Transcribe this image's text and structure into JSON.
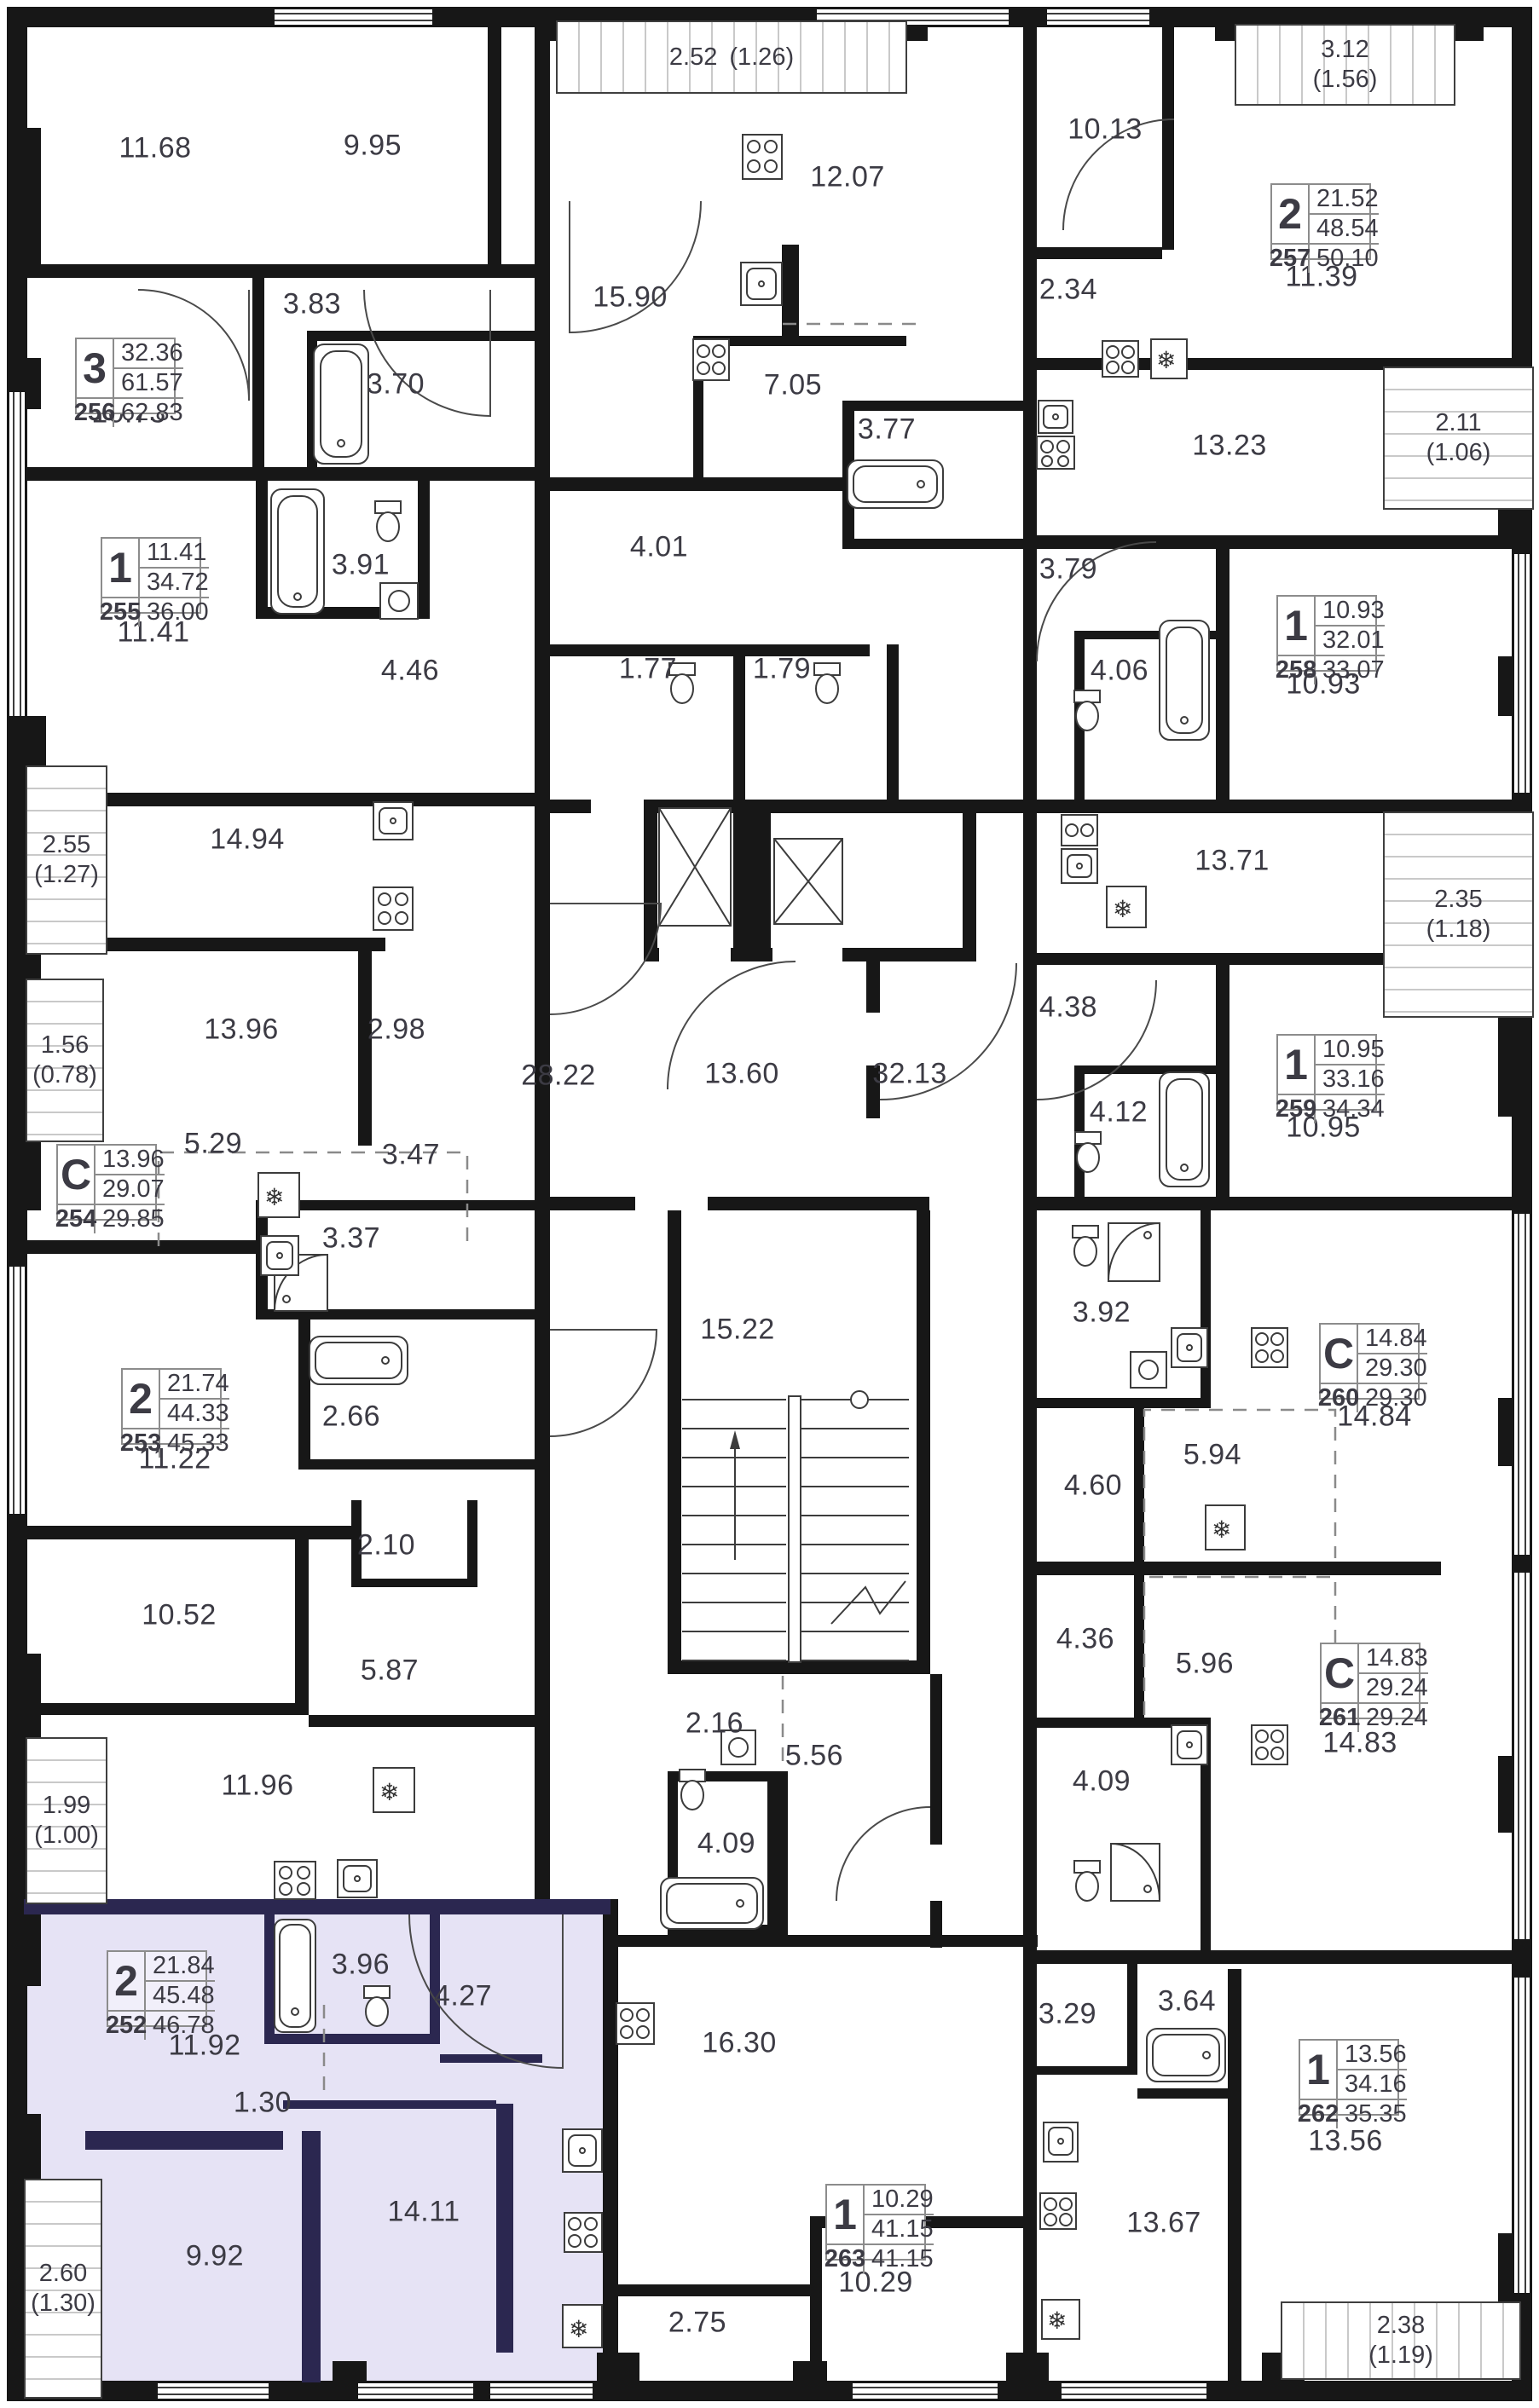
{
  "plan": {
    "highlight_color": "#e6e3f5",
    "wall_color": "#171717",
    "highlight_wall_color": "#2b2750",
    "apartments": [
      {
        "number": "256",
        "type": "3",
        "living": "32.36",
        "area": "61.57",
        "total": "62.83",
        "highlighted": false
      },
      {
        "number": "255",
        "type": "1",
        "living": "11.41",
        "area": "34.72",
        "total": "36.00",
        "highlighted": false
      },
      {
        "number": "254",
        "type": "С",
        "living": "13.96",
        "area": "29.07",
        "total": "29.85",
        "highlighted": false
      },
      {
        "number": "253",
        "type": "2",
        "living": "21.74",
        "area": "44.33",
        "total": "45.33",
        "highlighted": false
      },
      {
        "number": "252",
        "type": "2",
        "living": "21.84",
        "area": "45.48",
        "total": "46.78",
        "highlighted": true
      },
      {
        "number": "257",
        "type": "2",
        "living": "21.52",
        "area": "48.54",
        "total": "50.10",
        "highlighted": false
      },
      {
        "number": "258",
        "type": "1",
        "living": "10.93",
        "area": "32.01",
        "total": "33.07",
        "highlighted": false
      },
      {
        "number": "259",
        "type": "1",
        "living": "10.95",
        "area": "33.16",
        "total": "34.34",
        "highlighted": false
      },
      {
        "number": "260",
        "type": "С",
        "living": "14.84",
        "area": "29.30",
        "total": "29.30",
        "highlighted": false
      },
      {
        "number": "261",
        "type": "С",
        "living": "14.83",
        "area": "29.24",
        "total": "29.24",
        "highlighted": false
      },
      {
        "number": "262",
        "type": "1",
        "living": "13.56",
        "area": "34.16",
        "total": "35.35",
        "highlighted": false
      },
      {
        "number": "263",
        "type": "1",
        "living": "10.29",
        "area": "41.15",
        "total": "41.15",
        "highlighted": false
      }
    ],
    "balconies": [
      {
        "area": "2.52",
        "reduced": "(1.26)"
      },
      {
        "area": "3.12",
        "reduced": "(1.56)"
      },
      {
        "area": "2.11",
        "reduced": "(1.06)"
      },
      {
        "area": "2.35",
        "reduced": "(1.18)"
      },
      {
        "area": "2.55",
        "reduced": "(1.27)"
      },
      {
        "area": "1.56",
        "reduced": "(0.78)"
      },
      {
        "area": "1.99",
        "reduced": "(1.00)"
      },
      {
        "area": "2.60",
        "reduced": "(1.30)"
      },
      {
        "area": "2.38",
        "reduced": "(1.19)"
      }
    ],
    "rooms": [
      "11.68",
      "9.95",
      "3.83",
      "3.70",
      "10.73",
      "15.90",
      "12.07",
      "7.05",
      "10.13",
      "2.34",
      "11.39",
      "3.77",
      "4.01",
      "1.77",
      "1.79",
      "3.91",
      "11.41",
      "4.46",
      "13.23",
      "3.79",
      "4.06",
      "10.93",
      "14.94",
      "13.96",
      "2.98",
      "28.22",
      "13.60",
      "32.13",
      "4.38",
      "13.71",
      "10.95",
      "4.12",
      "5.29",
      "3.47",
      "3.37",
      "15.22",
      "3.92",
      "11.22",
      "2.66",
      "2.10",
      "14.84",
      "5.94",
      "4.60",
      "10.52",
      "5.87",
      "4.36",
      "5.96",
      "14.83",
      "11.96",
      "2.16",
      "5.56",
      "4.09",
      "4.09",
      "3.96",
      "4.27",
      "11.92",
      "1.30",
      "16.30",
      "3.29",
      "3.64",
      "13.56",
      "9.92",
      "14.11",
      "13.67",
      "2.75",
      "10.29"
    ]
  }
}
